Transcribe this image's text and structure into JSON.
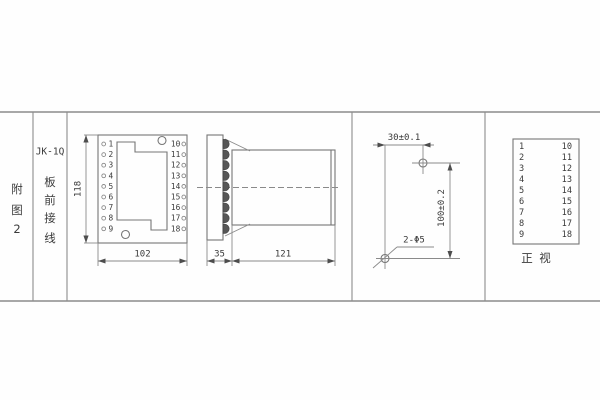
{
  "colors": {
    "background": "#fefefe",
    "line": "#8c8c8c",
    "drawing_line": "#767676",
    "text": "#3a3a3a"
  },
  "left_panel": {
    "figure_label": "附图2",
    "model": "JK-1Q",
    "mounting_label": "板前接线"
  },
  "front_view": {
    "terminals_left": [
      "1",
      "2",
      "3",
      "4",
      "5",
      "6",
      "7",
      "8",
      "9"
    ],
    "terminals_right": [
      "10",
      "11",
      "12",
      "13",
      "14",
      "15",
      "16",
      "17",
      "18"
    ],
    "height_dim": "118",
    "width_dim": "102"
  },
  "side_view": {
    "flange_dim": "35",
    "body_dim": "121"
  },
  "drill_view": {
    "spacing_dim": "30±0.1",
    "height_dim": "100±0.2",
    "holes_label": "2-Φ5"
  },
  "table_view": {
    "terminals_left": [
      "1",
      "2",
      "3",
      "4",
      "5",
      "6",
      "7",
      "8",
      "9"
    ],
    "terminals_right": [
      "10",
      "11",
      "12",
      "13",
      "14",
      "15",
      "16",
      "17",
      "18"
    ],
    "caption": "正视"
  }
}
